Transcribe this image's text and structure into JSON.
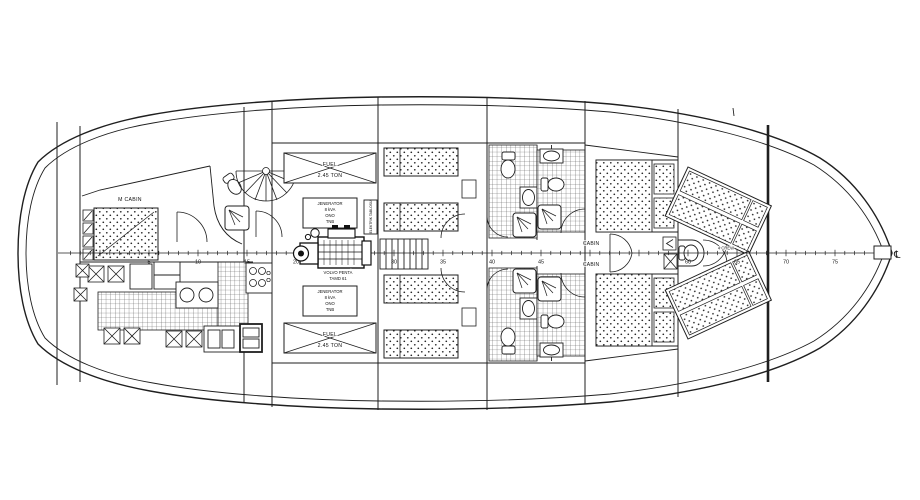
{
  "drawing": {
    "labels": {
      "master_cabin": "M CABIN",
      "fuel": "FUEL",
      "fuel_capacity": "2.45 TON",
      "generator": [
        "JENERATOR",
        "8 kVA",
        "ONO",
        "TNB"
      ],
      "engine": [
        "VOLVO PENTA",
        "TAMD 61"
      ],
      "electric_panel": "ELEKTRIK TABLOSU",
      "cabin_upper": "CABIN",
      "cabin_lower": "CABIN",
      "crew": "4 CREW",
      "centerline_symbol": "℄"
    },
    "centerline": {
      "x0": 100,
      "px_per_station": 9.8,
      "tick_start": -3,
      "tick_end": 78,
      "numbered": [
        5,
        10,
        15,
        20,
        25,
        30,
        35,
        40,
        45,
        60,
        65,
        70,
        75
      ]
    }
  }
}
